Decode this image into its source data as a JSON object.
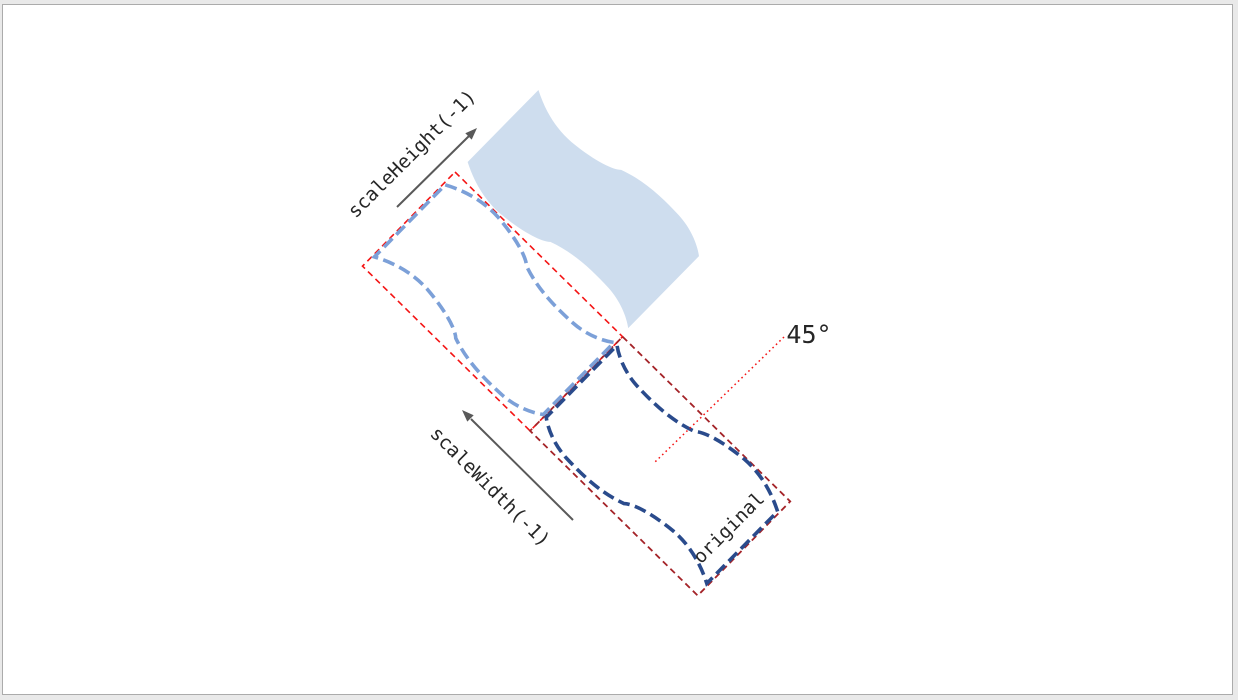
{
  "page": {
    "background": "#e9e9e9",
    "canvas_background": "#ffffff",
    "canvas_border": "#ababab"
  },
  "diagram": {
    "angle_label": "45°",
    "labels": {
      "scale_height": "scaleHeight(-1)",
      "scale_width": "scaleWidth(-1)",
      "original": "original"
    },
    "colors": {
      "result_flag_fill": "#CEDDEE",
      "flipped_outline": "#7CA0D8",
      "original_outline": "#2A4B8C",
      "flipped_bbox": "#F41414",
      "original_bbox": "#A42328",
      "angle_line": "#F41414",
      "arrow": "#595959",
      "text": "#262626"
    }
  }
}
